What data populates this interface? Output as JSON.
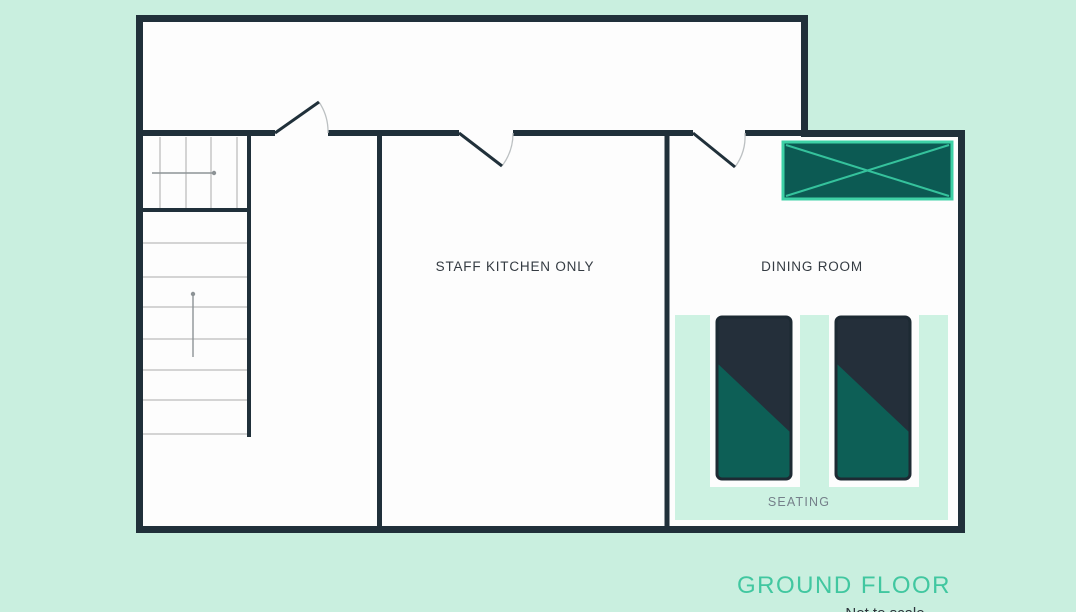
{
  "colors": {
    "bg": "#c9efdf",
    "wall": "#20303a",
    "floor": "#fdfdfd",
    "tread": "#c6c6c6",
    "arrow": "#8d9396",
    "arc": "#bcc0c2",
    "counter-fill": "#0c5a53",
    "counter-border": "#3ed1a6",
    "counter-x": "#35c29c",
    "rug": "#cdf2e2",
    "table-dark": "#242f3a",
    "table-teal": "#0d5f56",
    "table-border": "#1d2a33",
    "label-dark": "#343b42",
    "label-gray": "#75808a",
    "title-teal": "#41c7a0",
    "note-dark": "#2c343b"
  },
  "rooms": {
    "staff_kitchen": {
      "label": "STAFF KITCHEN ONLY"
    },
    "dining": {
      "label": "DINING ROOM"
    },
    "seating": {
      "label": "SEATING"
    }
  },
  "footer": {
    "title": "GROUND FLOOR",
    "note": "Not to scale"
  }
}
